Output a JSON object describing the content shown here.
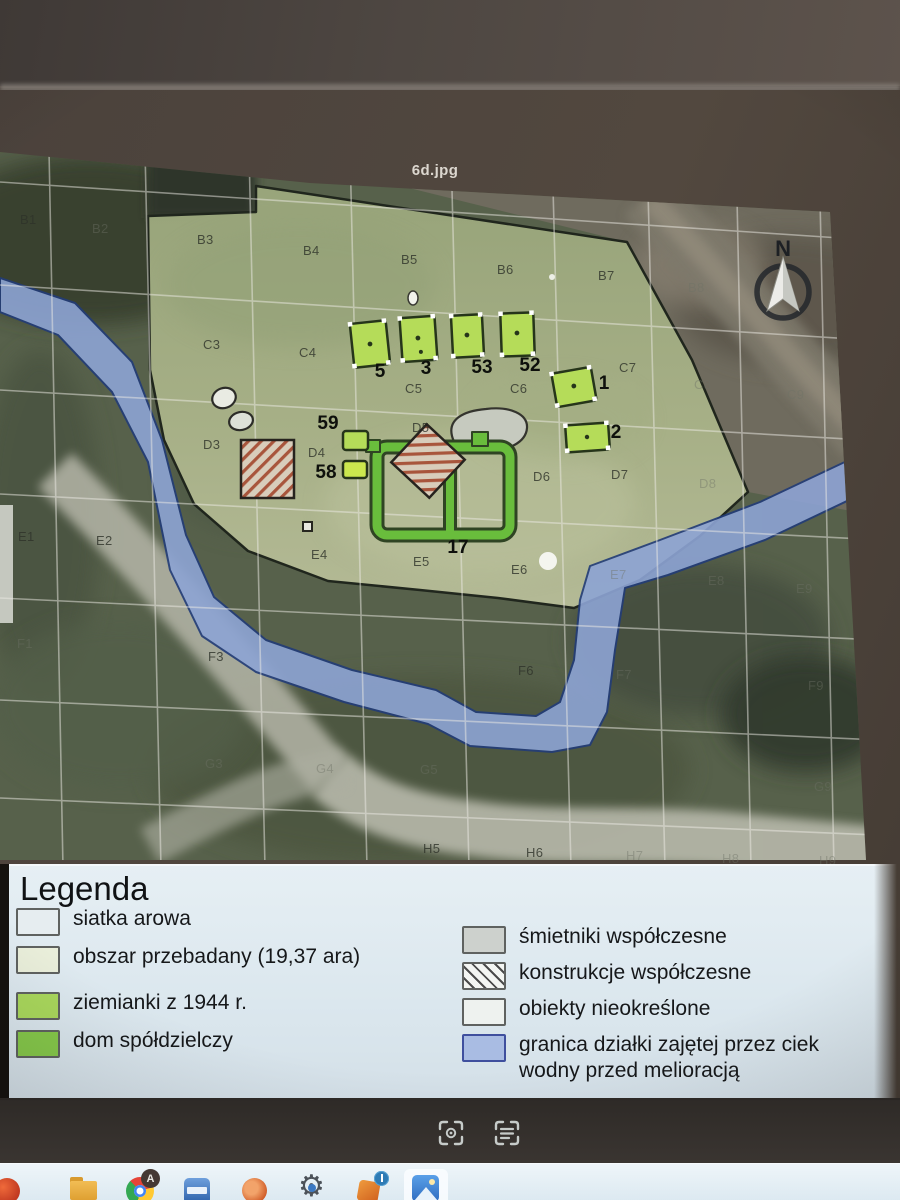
{
  "viewer": {
    "title": "6d.jpg",
    "toolbar_icons": [
      "scan-text-icon",
      "visual-search-icon"
    ]
  },
  "map": {
    "north_label": "N",
    "grid_labels": [
      {
        "t": "B1",
        "x": 20,
        "y": 212
      },
      {
        "t": "B2",
        "x": 92,
        "y": 221,
        "dim": 1
      },
      {
        "t": "B3",
        "x": 197,
        "y": 232
      },
      {
        "t": "B4",
        "x": 303,
        "y": 243
      },
      {
        "t": "B5",
        "x": 401,
        "y": 252
      },
      {
        "t": "B6",
        "x": 497,
        "y": 262
      },
      {
        "t": "B7",
        "x": 598,
        "y": 268
      },
      {
        "t": "B8",
        "x": 688,
        "y": 280,
        "dim": 1
      },
      {
        "t": "C3",
        "x": 203,
        "y": 337
      },
      {
        "t": "C4",
        "x": 299,
        "y": 345
      },
      {
        "t": "C5",
        "x": 405,
        "y": 381
      },
      {
        "t": "C6",
        "x": 510,
        "y": 381
      },
      {
        "t": "C7",
        "x": 619,
        "y": 360
      },
      {
        "t": "C8",
        "x": 694,
        "y": 377,
        "dim": 1
      },
      {
        "t": "C9",
        "x": 787,
        "y": 387,
        "dim": 1
      },
      {
        "t": "D3",
        "x": 203,
        "y": 437
      },
      {
        "t": "D4",
        "x": 308,
        "y": 445
      },
      {
        "t": "D5",
        "x": 412,
        "y": 420
      },
      {
        "t": "D6",
        "x": 533,
        "y": 469
      },
      {
        "t": "D7",
        "x": 611,
        "y": 467
      },
      {
        "t": "D8",
        "x": 699,
        "y": 476,
        "dim": 1
      },
      {
        "t": "E1",
        "x": 18,
        "y": 529
      },
      {
        "t": "E2",
        "x": 96,
        "y": 533
      },
      {
        "t": "E4",
        "x": 311,
        "y": 547
      },
      {
        "t": "E5",
        "x": 413,
        "y": 554
      },
      {
        "t": "E6",
        "x": 511,
        "y": 562
      },
      {
        "t": "E7",
        "x": 610,
        "y": 567,
        "dim": 1
      },
      {
        "t": "E8",
        "x": 708,
        "y": 573,
        "dim": 1
      },
      {
        "t": "E9",
        "x": 796,
        "y": 581,
        "dim": 1
      },
      {
        "t": "F1",
        "x": 17,
        "y": 636,
        "dim": 1
      },
      {
        "t": "F3",
        "x": 208,
        "y": 649
      },
      {
        "t": "F6",
        "x": 518,
        "y": 663
      },
      {
        "t": "F7",
        "x": 616,
        "y": 667,
        "dim": 1
      },
      {
        "t": "F9",
        "x": 808,
        "y": 678,
        "dim": 1
      },
      {
        "t": "G3",
        "x": 205,
        "y": 756,
        "dim": 1
      },
      {
        "t": "G4",
        "x": 316,
        "y": 761,
        "dim": 1
      },
      {
        "t": "G5",
        "x": 420,
        "y": 762,
        "dim": 1
      },
      {
        "t": "G9",
        "x": 814,
        "y": 779,
        "dim": 1
      },
      {
        "t": "H5",
        "x": 423,
        "y": 841
      },
      {
        "t": "H6",
        "x": 526,
        "y": 845
      },
      {
        "t": "H7",
        "x": 626,
        "y": 848,
        "dim": 1
      },
      {
        "t": "H8",
        "x": 722,
        "y": 851,
        "dim": 1
      },
      {
        "t": "H9",
        "x": 819,
        "y": 853,
        "dim": 1
      }
    ],
    "feature_numbers": [
      {
        "t": "5",
        "x": 380,
        "y": 372
      },
      {
        "t": "3",
        "x": 426,
        "y": 369
      },
      {
        "t": "53",
        "x": 482,
        "y": 368
      },
      {
        "t": "52",
        "x": 530,
        "y": 366
      },
      {
        "t": "1",
        "x": 604,
        "y": 384
      },
      {
        "t": "2",
        "x": 616,
        "y": 433
      },
      {
        "t": "59",
        "x": 328,
        "y": 424
      },
      {
        "t": "58",
        "x": 326,
        "y": 473
      },
      {
        "t": "17",
        "x": 458,
        "y": 548
      }
    ]
  },
  "legend": {
    "title": "Legenda",
    "left": [
      {
        "key": "grid",
        "label": "siatka arowa"
      },
      {
        "key": "surveyed",
        "label": "obszar przebadany (19,37 ara)"
      },
      {
        "key": "dugout",
        "label": "ziemianki z 1944 r.",
        "gap": 1
      },
      {
        "key": "coop",
        "label": "dom spółdzielczy"
      }
    ],
    "right": [
      {
        "key": "trash",
        "label": "śmietniki współczesne"
      },
      {
        "key": "constr",
        "label": "konstrukcje współczesne"
      },
      {
        "key": "undef",
        "label": "obiekty nieokreślone"
      },
      {
        "key": "stream",
        "label": "granica działki zajętej przez ciek wodny przed melioracją"
      }
    ]
  },
  "taskbar": {
    "profile_badge": "A",
    "icons": [
      "red-browser-icon",
      "file-explorer-icon",
      "chrome-browser-icon",
      "blue-app-icon",
      "office-app-icon",
      "settings-gear-icon",
      "info-badge-app-icon",
      "photos-app-icon"
    ]
  },
  "colors": {
    "surveyed_area": "#a3ae85",
    "dugout_green": "#b5dc59",
    "coop_green": "#69bd3c",
    "stream_blue": "#8da4d4",
    "hatch_stripe": "#a8553c",
    "trash_gray": "#c6cabf",
    "legend_bg": "#dde8ee",
    "taskbar_bg": "#ddeaf2",
    "photo_frame": "#4b423c"
  }
}
